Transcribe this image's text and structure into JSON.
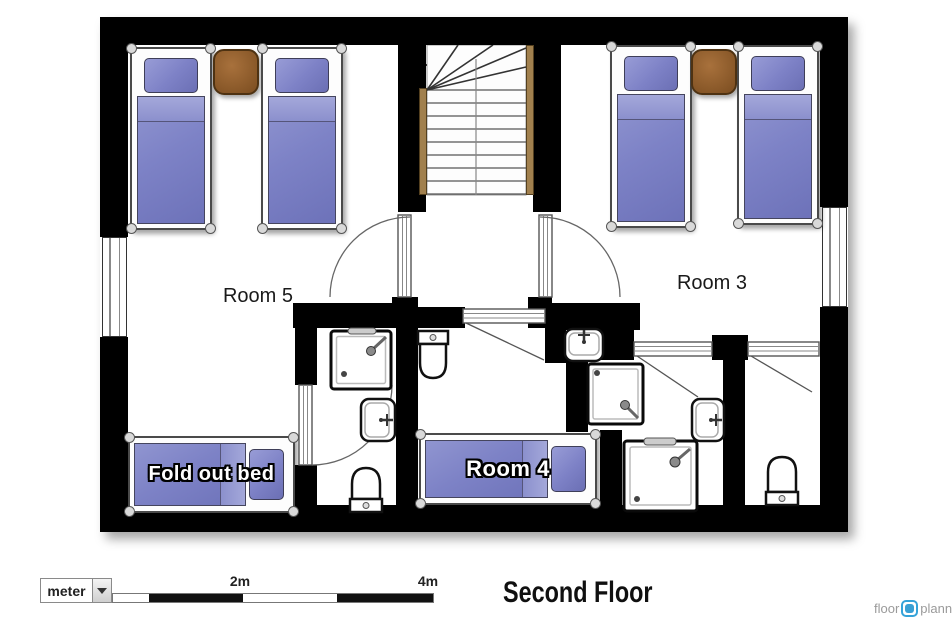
{
  "title": "Second Floor",
  "labels": {
    "room5": "Room 5",
    "room3": "Room 3",
    "room4": "Room 4",
    "fold_out_bed": "Fold out bed"
  },
  "scale_bar": {
    "unit": "meter",
    "mark2": "2m",
    "mark4": "4m"
  },
  "logo": {
    "part1": "floor",
    "part2": "planner"
  },
  "colors": {
    "wall": "#000000",
    "bed_duvet": "#7d82c6",
    "bed_pillow": "#8488c9",
    "table_brown": "#8a5a2f",
    "stair_rail": "#a1804e",
    "logo_blue": "#35a3d9",
    "logo_gray": "#9a9a9a"
  },
  "plan": {
    "floor_name": "Second Floor",
    "rooms": [
      {
        "name": "Room 5",
        "furniture": [
          "single bed",
          "single bed",
          "bedside table",
          "fold out bed"
        ]
      },
      {
        "name": "Room 3",
        "furniture": [
          "single bed",
          "single bed",
          "bedside table"
        ]
      },
      {
        "name": "Room 4",
        "furniture": [
          "single bed",
          "toilet"
        ]
      },
      {
        "name": "bathroom left",
        "furniture": [
          "shower",
          "sink",
          "toilet"
        ]
      },
      {
        "name": "bathroom middle",
        "furniture": [
          "shower",
          "shower",
          "sink",
          "sink"
        ]
      },
      {
        "name": "bathroom right",
        "furniture": [
          "toilet"
        ]
      },
      {
        "name": "stairwell",
        "furniture": [
          "staircase"
        ]
      }
    ],
    "windows": 2,
    "doors": 6
  }
}
